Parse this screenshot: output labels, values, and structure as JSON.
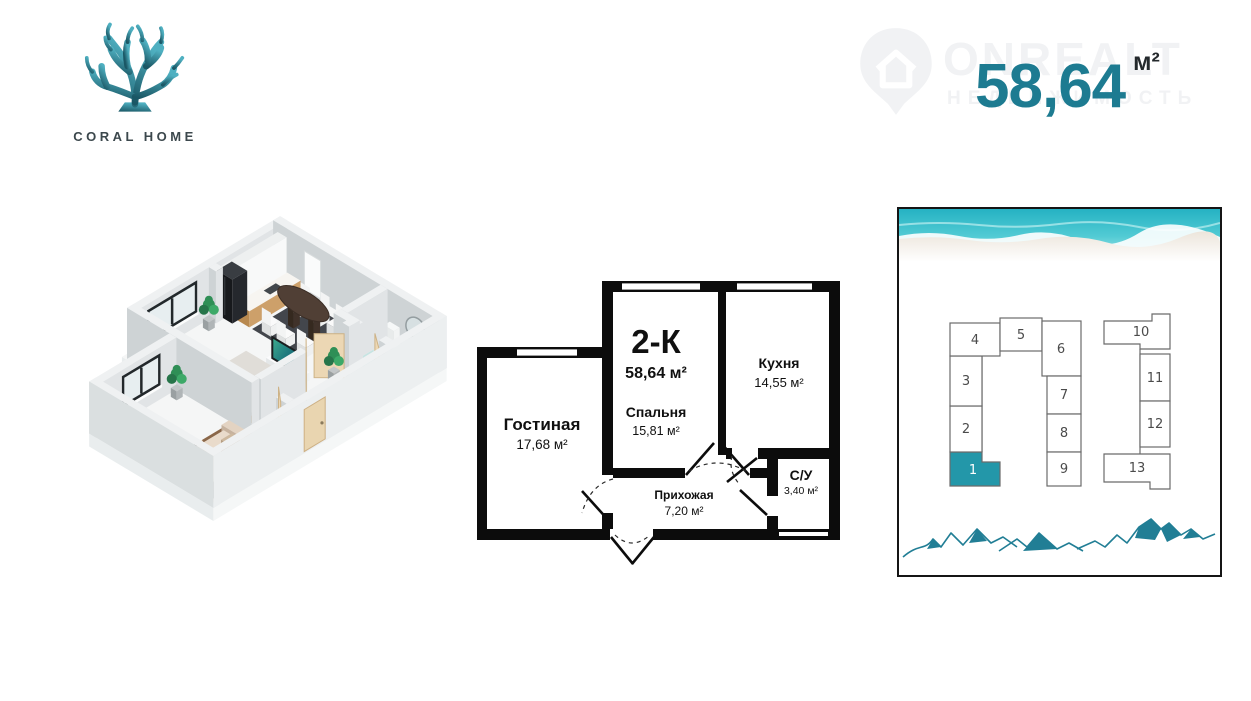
{
  "brand": {
    "name": "CORAL HOME"
  },
  "watermark": {
    "name": "ONREALT",
    "subtitle": "НЕДВИЖИМОСТЬ"
  },
  "area_display": {
    "value": "58,64",
    "unit": "м²"
  },
  "floor_plan": {
    "type_label": "2-К",
    "total_area": "58,64 м²",
    "rooms": {
      "living": {
        "name": "Гостиная",
        "area": "17,68 м²"
      },
      "bedroom": {
        "name": "Спальня",
        "area": "15,81 м²"
      },
      "kitchen": {
        "name": "Кухня",
        "area": "14,55 м²"
      },
      "hallway": {
        "name": "Прихожая",
        "area": "7,20 м²"
      },
      "bathroom": {
        "name": "С/У",
        "area": "3,40 м²"
      }
    }
  },
  "site_plan": {
    "highlighted_unit": "1",
    "units": [
      {
        "label": "1",
        "highlighted": true
      },
      {
        "label": "2"
      },
      {
        "label": "3"
      },
      {
        "label": "4"
      },
      {
        "label": "5"
      },
      {
        "label": "6"
      },
      {
        "label": "7"
      },
      {
        "label": "8"
      },
      {
        "label": "9"
      },
      {
        "label": "10"
      },
      {
        "label": "11"
      },
      {
        "label": "12"
      },
      {
        "label": "13"
      }
    ]
  },
  "colors": {
    "accent": "#1d7b91",
    "unit_highlight": "#2397a9",
    "mountains": "#217e95",
    "sea": "#2db6c5",
    "walls": "#0c0c0c"
  }
}
